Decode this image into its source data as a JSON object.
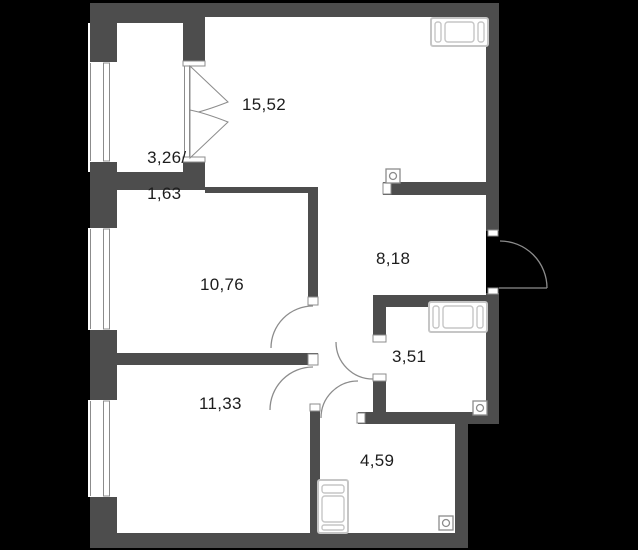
{
  "plan": {
    "title": "Apartment floor plan",
    "rooms": [
      {
        "id": "living-room",
        "area": "15,52"
      },
      {
        "id": "balcony",
        "area_full": "3,26/",
        "area_reduced": "1,63"
      },
      {
        "id": "bedroom-upper",
        "area": "10,76"
      },
      {
        "id": "hallway",
        "area": "8,18"
      },
      {
        "id": "bathroom",
        "area": "3,51"
      },
      {
        "id": "bedroom-lower",
        "area": "11,33"
      },
      {
        "id": "storage-room",
        "area": "4,59"
      }
    ],
    "fixtures": [
      {
        "name": "bathtub-icon",
        "location": "living-room top-right"
      },
      {
        "name": "bathtub-icon",
        "location": "bathroom top"
      },
      {
        "name": "washing-machine-icon",
        "location": "storage-room left"
      },
      {
        "name": "ventilation-grille-icon",
        "location": "living-room above hallway wall"
      },
      {
        "name": "ventilation-grille-icon",
        "location": "bathroom bottom-right"
      },
      {
        "name": "ventilation-grille-icon",
        "location": "storage-room bottom-right"
      },
      {
        "name": "double-door-swing-icon",
        "location": "balcony to living-room"
      },
      {
        "name": "door-swing-icon",
        "location": "entrance right wall"
      },
      {
        "name": "door-swing-icon",
        "location": "bedroom-upper"
      },
      {
        "name": "door-swing-icon",
        "location": "bedroom-lower"
      },
      {
        "name": "door-swing-icon",
        "location": "bathroom"
      },
      {
        "name": "door-swing-icon",
        "location": "storage-room"
      },
      {
        "name": "window-icon",
        "location": "left wall x3"
      }
    ],
    "colors": {
      "background": "#000000",
      "wall": "#4d4d4d",
      "floor": "#ffffff",
      "line": "#8c8c8c",
      "fixture": "#c6c6c6",
      "text": "#1d1d1d"
    }
  }
}
